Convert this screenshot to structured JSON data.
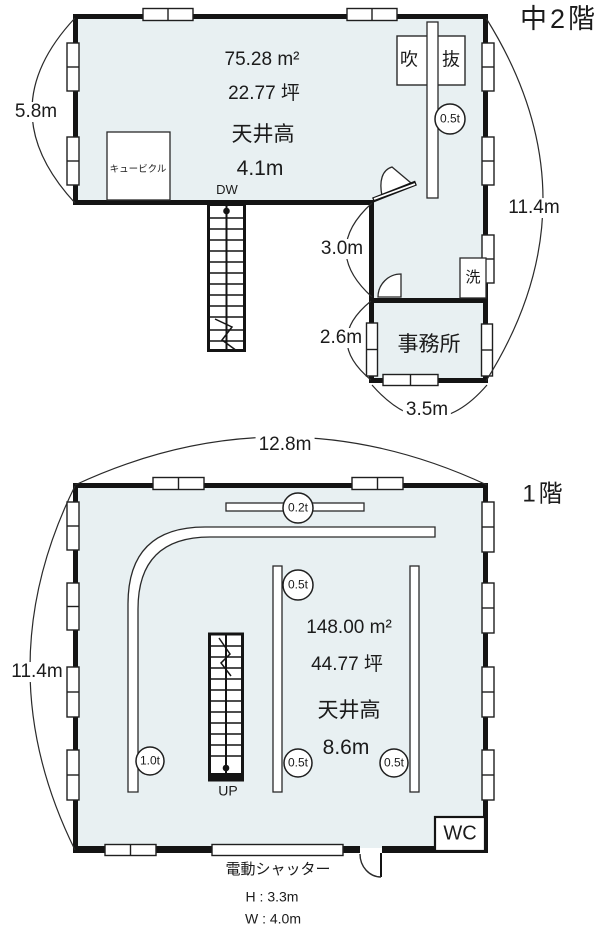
{
  "colors": {
    "room_fill": "#e8f0f2",
    "wall": "#141414",
    "line": "#2a2a2a"
  },
  "mezzanine": {
    "title": "中2階",
    "area_m2": "75.28 m²",
    "area_tsubo": "22.77 坪",
    "ceiling_label": "天井高",
    "ceiling_height": "4.1m",
    "dumbwaiter": "DW",
    "cubicle": "キュービクル",
    "void_char1": "吹",
    "void_char2": "抜",
    "wash": "洗",
    "office": "事務所",
    "beam_load": "0.5t",
    "dims": {
      "left": "5.8m",
      "right": "11.4m",
      "corridor": "3.0m",
      "office_height": "2.6m",
      "office_width": "3.5m"
    }
  },
  "first_floor": {
    "title": "1階",
    "area_m2": "148.00 m²",
    "area_tsubo": "44.77 坪",
    "ceiling_label": "天井高",
    "ceiling_height": "8.6m",
    "stairs_label": "UP",
    "wc": "WC",
    "dims": {
      "top": "12.8m",
      "left": "11.4m"
    },
    "loads": {
      "top_beam": "0.2t",
      "mid_beam_upper": "0.5t",
      "left_rail": "1.0t",
      "mid_beam_lower": "0.5t",
      "right_beam": "0.5t"
    },
    "shutter": {
      "label": "電動シャッター",
      "height": "H : 3.3m",
      "width": "W : 4.0m"
    }
  }
}
